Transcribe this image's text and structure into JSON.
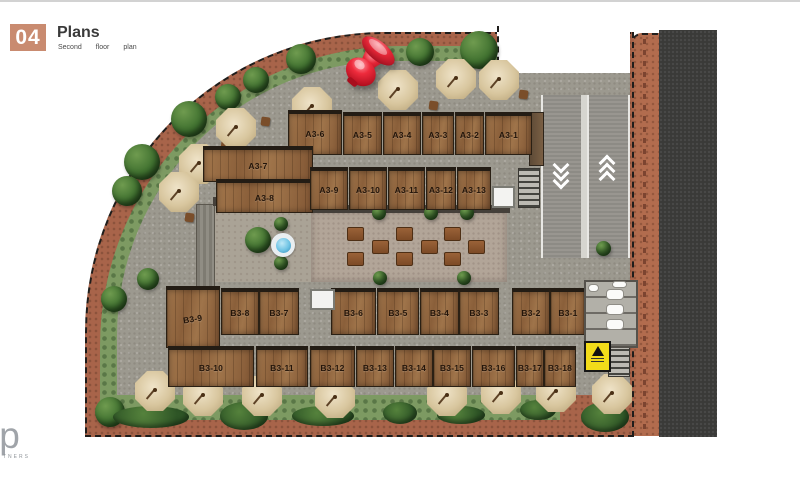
{
  "header": {
    "number": "04",
    "title": "Plans",
    "subtitle_words": [
      "Second",
      "floor",
      "plan"
    ]
  },
  "branding": {
    "letters": "lp",
    "caption": "TNERS"
  },
  "plan": {
    "units": {
      "a_top": [
        "A3-6",
        "A3-5",
        "A3-4",
        "A3-3",
        "A3-2",
        "A3-1"
      ],
      "a_left": [
        "A3-7",
        "A3-8"
      ],
      "a_inner": [
        "A3-9",
        "A3-10",
        "A3-11",
        "A3-12",
        "A3-13"
      ],
      "b_mid": [
        "B3-9",
        "B3-8",
        "B3-7",
        "B3-6",
        "B3-5",
        "B3-4",
        "B3-3",
        "B3-2",
        "B3-1"
      ],
      "b_bottom": [
        "B3-10",
        "B3-11",
        "B3-12",
        "B3-13",
        "B3-14",
        "B3-15",
        "B3-16",
        "B3-17",
        "B3-18"
      ]
    },
    "icons": {
      "ramp_down": "chevrons-down",
      "ramp_up": "chevrons-up",
      "warning_sign": "exclamation-triangle",
      "pushpin": "red-pushpin",
      "fountain": "fountain"
    },
    "colors": {
      "accent_square": "#c98b70",
      "terracotta": "#a8644a",
      "green": "#7d9a62",
      "walkway_grey": "#9c998f",
      "wood": "#966b42",
      "road": "#3a3a38",
      "warning_yellow": "#f2dc1a",
      "pin_red": "#d91f2e",
      "fountain_blue": "#6ec3e4"
    }
  }
}
